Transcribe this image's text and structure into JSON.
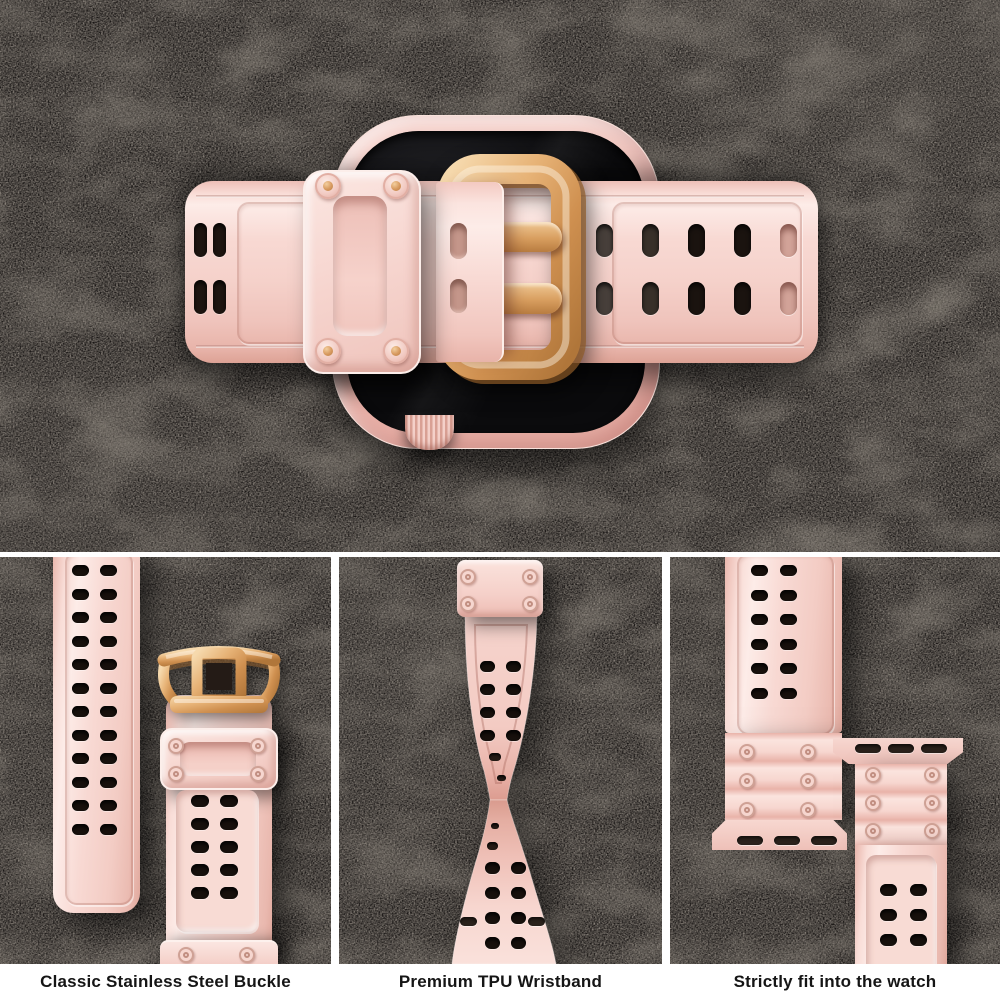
{
  "captions": {
    "buckle": "Classic Stainless Steel Buckle",
    "wristband": "Premium TPU Wristband",
    "fit": "Strictly fit into the watch"
  },
  "colors": {
    "page_background": "#ffffff",
    "slate_background": "#171413",
    "band_pink": "#f7d6cf",
    "band_pink_highlight": "#fdece8",
    "band_pink_shadow": "#e3a89d",
    "rose_gold": "#d6985c",
    "rose_gold_light": "#f3d2a2",
    "rose_gold_dark": "#a86f33",
    "screen_black": "#0b0b0d",
    "hole_black": "#1a130f",
    "caption_text": "#151515"
  }
}
